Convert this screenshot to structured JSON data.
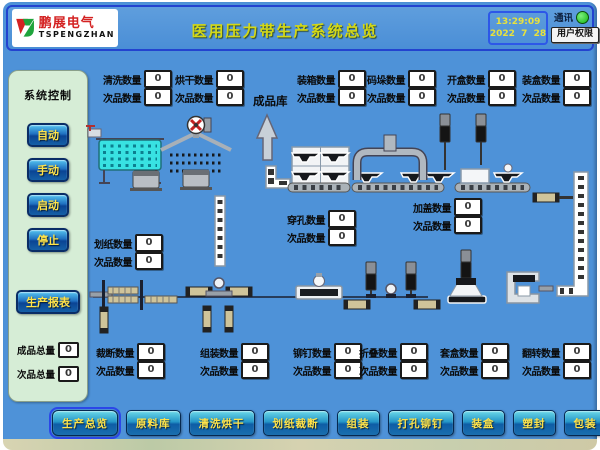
{
  "header": {
    "brand": "鹏展电气",
    "brand_sub": "TSPENGZHAN",
    "title": "医用压力带生产系统总览",
    "time": "13:29:09",
    "date": "2022  7  28",
    "comm_label": "通讯",
    "user_button": "用户权限"
  },
  "sidebar": {
    "title": "系统控制",
    "mode_buttons": [
      {
        "id": "auto",
        "label": "自动"
      },
      {
        "id": "manual",
        "label": "手动"
      },
      {
        "id": "start",
        "label": "启动"
      },
      {
        "id": "stop",
        "label": "停止"
      }
    ],
    "report_button": "生产报表",
    "totals": [
      {
        "id": "finished-total",
        "label": "成品总量",
        "value": "0"
      },
      {
        "id": "defect-total",
        "label": "次品总量",
        "value": "0"
      }
    ]
  },
  "plant": {
    "store_label": "成品库",
    "counters": [
      {
        "id": "wash",
        "label": "清洗数量",
        "value": "0",
        "sub_label": "次品数量",
        "sub_value": "0",
        "x": 99,
        "y": 70
      },
      {
        "id": "dry",
        "label": "烘干数量",
        "value": "0",
        "sub_label": "次品数量",
        "sub_value": "0",
        "x": 171,
        "y": 70
      },
      {
        "id": "box-pack",
        "label": "装箱数量",
        "value": "0",
        "sub_label": "次品数量",
        "sub_value": "0",
        "x": 293,
        "y": 70
      },
      {
        "id": "palletize",
        "label": "码垛数量",
        "value": "0",
        "sub_label": "次品数量",
        "sub_value": "0",
        "x": 363,
        "y": 70
      },
      {
        "id": "open-box",
        "label": "开盒数量",
        "value": "0",
        "sub_label": "次品数量",
        "sub_value": "0",
        "x": 443,
        "y": 70
      },
      {
        "id": "case-pack",
        "label": "装盒数量",
        "value": "0",
        "sub_label": "次品数量",
        "sub_value": "0",
        "x": 518,
        "y": 70
      },
      {
        "id": "paper-score",
        "label": "划纸数量",
        "value": "0",
        "sub_label": "次品数量",
        "sub_value": "0",
        "x": 90,
        "y": 234
      },
      {
        "id": "punch",
        "label": "穿孔数量",
        "value": "0",
        "sub_label": "次品数量",
        "sub_value": "0",
        "x": 283,
        "y": 210
      },
      {
        "id": "cap",
        "label": "加盖数量",
        "value": "0",
        "sub_label": "次品数量",
        "sub_value": "0",
        "x": 409,
        "y": 198
      },
      {
        "id": "cut",
        "label": "裁断数量",
        "value": "0",
        "sub_label": "次品数量",
        "sub_value": "0",
        "x": 92,
        "y": 343
      },
      {
        "id": "assemble",
        "label": "组装数量",
        "value": "0",
        "sub_label": "次品数量",
        "sub_value": "0",
        "x": 196,
        "y": 343
      },
      {
        "id": "rivet",
        "label": "铆钉数量",
        "value": "0",
        "sub_label": "次品数量",
        "sub_value": "0",
        "x": 289,
        "y": 343
      },
      {
        "id": "fold",
        "label": "折叠数量",
        "value": "0",
        "sub_label": "次品数量",
        "sub_value": "0",
        "x": 355,
        "y": 343
      },
      {
        "id": "sleeve",
        "label": "套盒数量",
        "value": "0",
        "sub_label": "次品数量",
        "sub_value": "0",
        "x": 436,
        "y": 343
      },
      {
        "id": "flip",
        "label": "翻转数量",
        "value": "0",
        "sub_label": "次品数量",
        "sub_value": "0",
        "x": 518,
        "y": 343
      }
    ]
  },
  "nav": {
    "items": [
      {
        "id": "overview",
        "label": "生产总览",
        "active": true
      },
      {
        "id": "material-store",
        "label": "原料库"
      },
      {
        "id": "wash-dry",
        "label": "清洗烘干"
      },
      {
        "id": "score-cut",
        "label": "划纸裁断"
      },
      {
        "id": "assembly",
        "label": "组装"
      },
      {
        "id": "punch-rivet",
        "label": "打孔铆钉"
      },
      {
        "id": "boxing",
        "label": "装盒"
      },
      {
        "id": "sealing",
        "label": "塑封"
      },
      {
        "id": "packing",
        "label": "包装"
      },
      {
        "id": "finished-buffer",
        "label": "成品暂存"
      }
    ]
  },
  "colors": {
    "screen_bg": "#4e92d8",
    "title_yellow": "#d4d816",
    "button_text_yellow": "#ffe34a",
    "sidebar_bg": "#d6edd6",
    "led_green": "#1ed21e"
  }
}
